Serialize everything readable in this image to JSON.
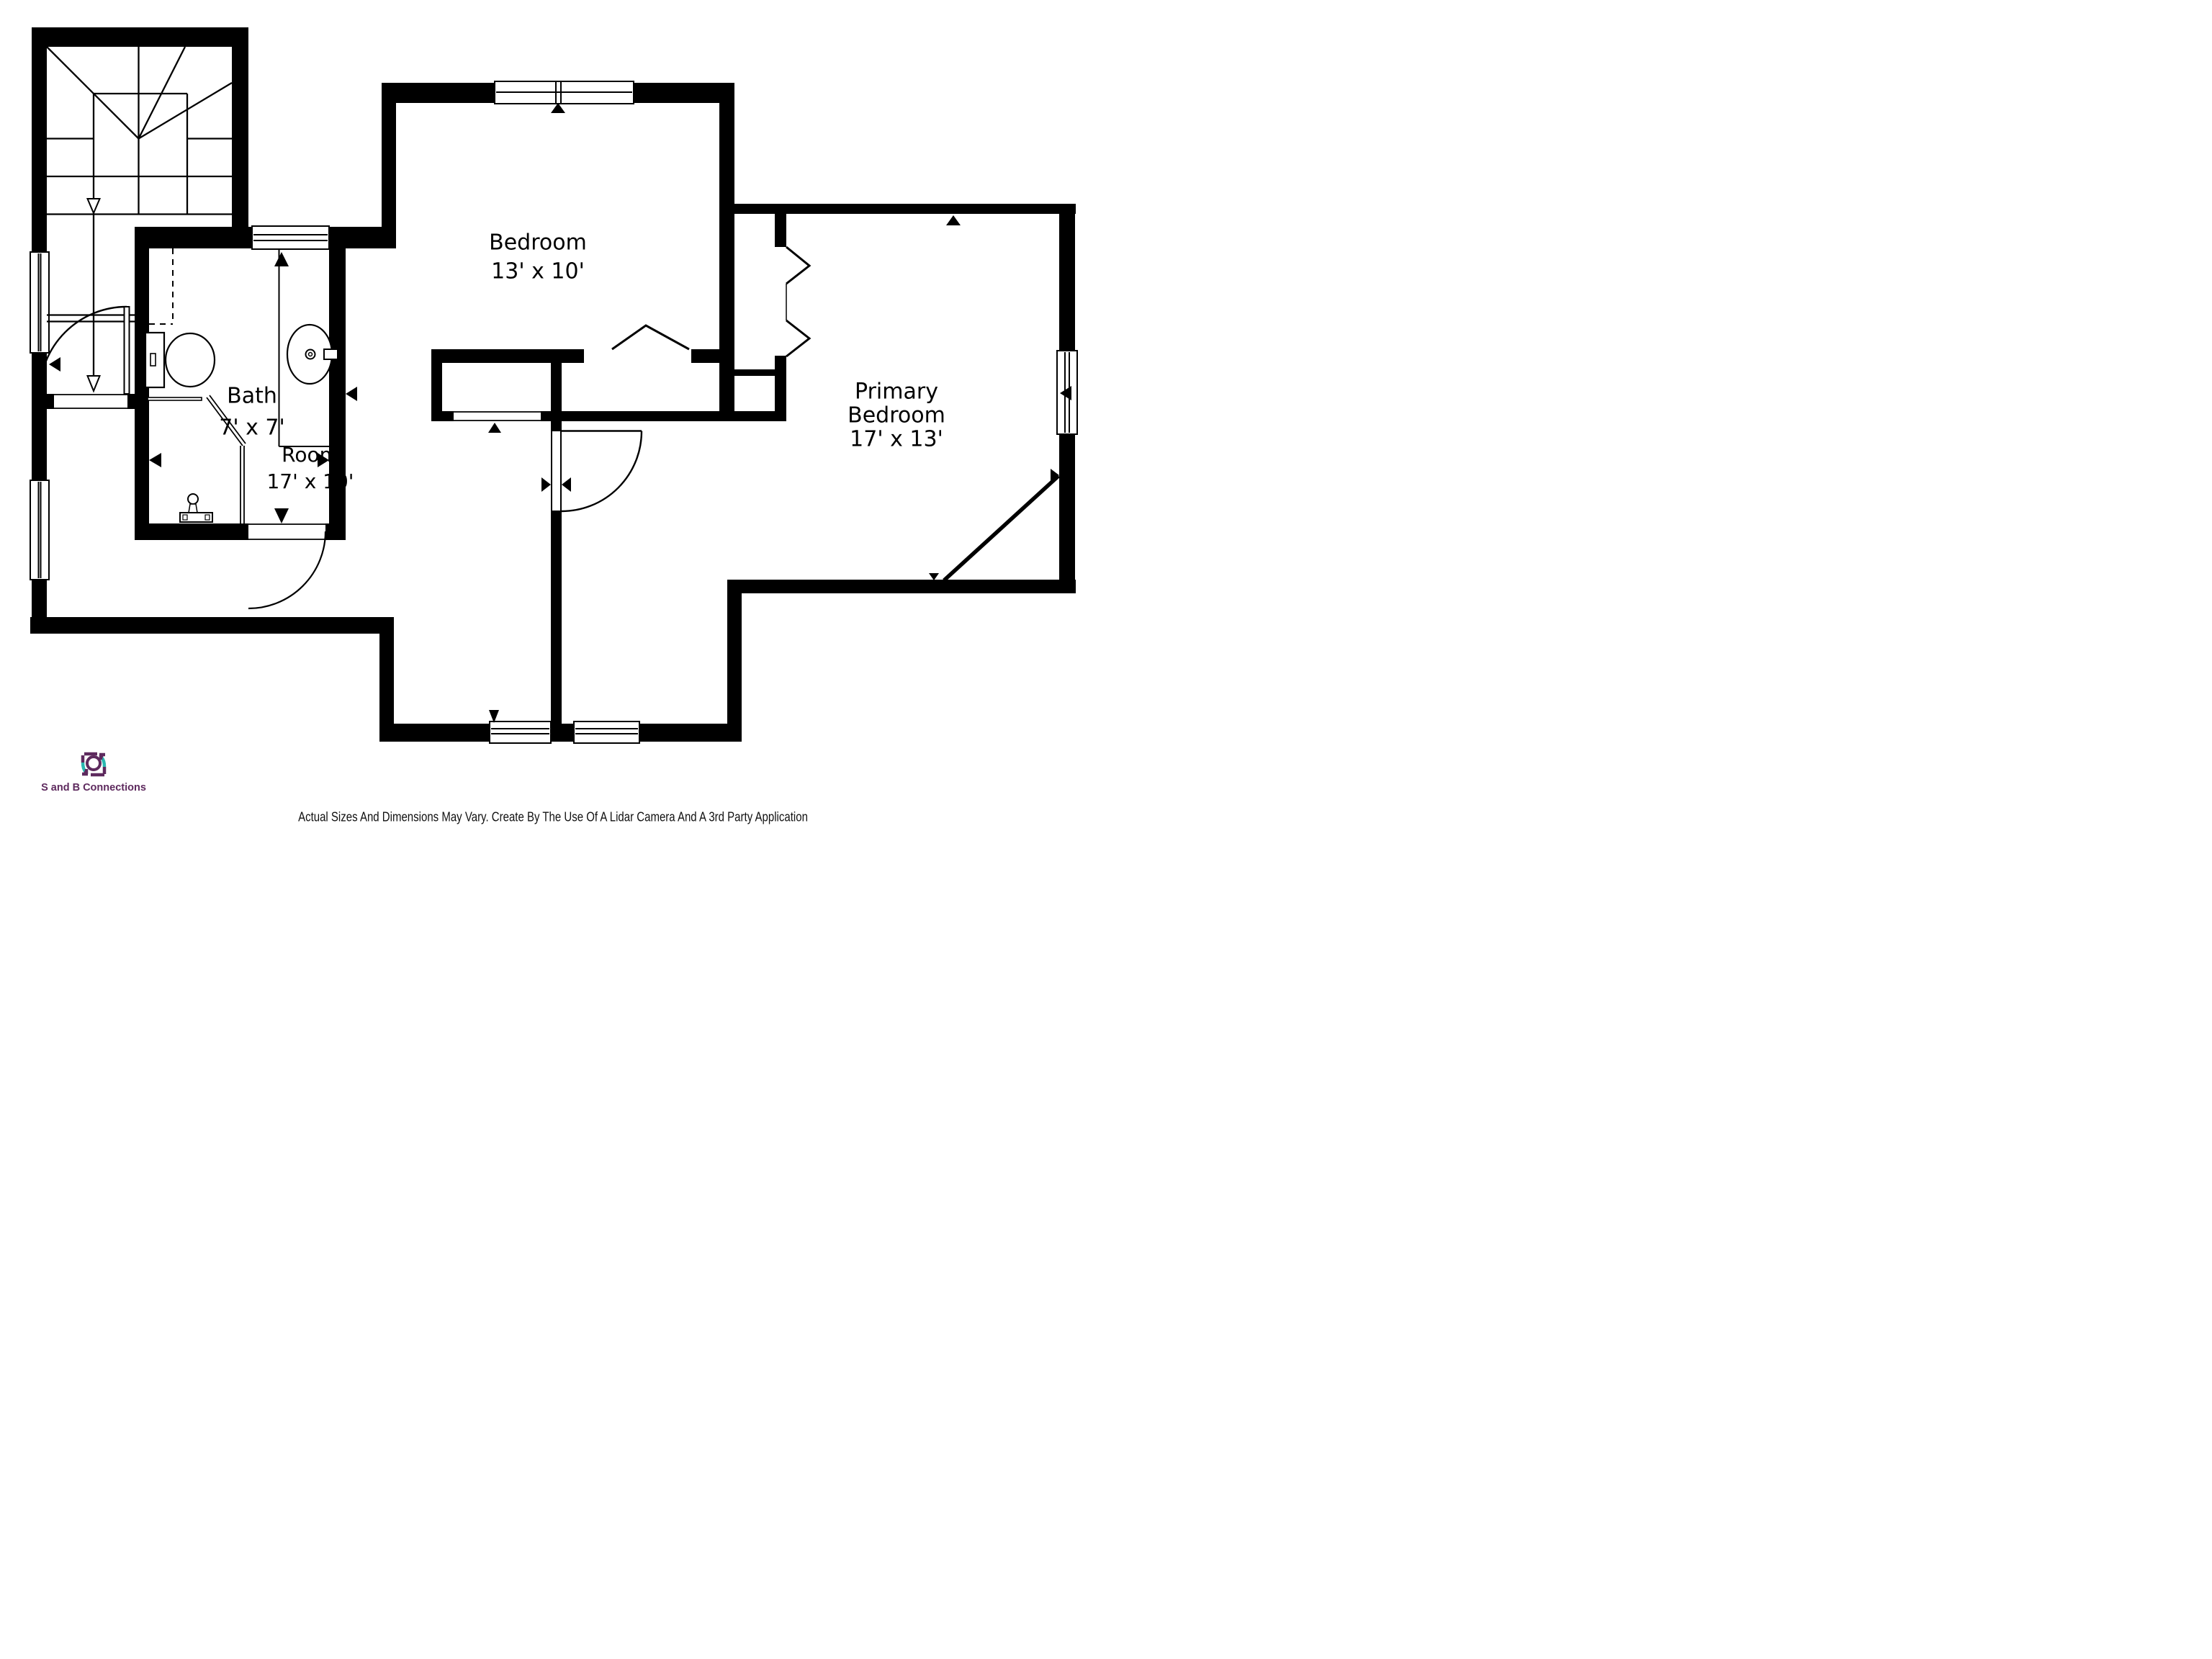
{
  "plan": {
    "rooms": [
      {
        "id": "bedroom",
        "name": "Bedroom",
        "dims": "13' x 10'"
      },
      {
        "id": "bath",
        "name": "Bath",
        "dims": "7' x 7'"
      },
      {
        "id": "room",
        "name": "Room",
        "dims": "17' x 10'"
      },
      {
        "id": "primary-bedroom",
        "name": "Primary Bedroom",
        "dims": "17' x 13'"
      }
    ],
    "symbols": [
      "stair-down-arrow",
      "door-swing-arc",
      "window",
      "closet-bifold-chevron",
      "toilet-icon",
      "sink-icon",
      "opening-marker-triangle"
    ]
  },
  "branding": {
    "logo_text": "S and B Connections",
    "logo_icon": "camera-icon",
    "purple": "#5E2A5E",
    "teal": "#2BB8B0"
  },
  "footer": {
    "disclaimer": "Actual Sizes And Dimensions May Vary. Create By The Use Of A Lidar Camera And A 3rd Party Application"
  },
  "colors": {
    "walls": "#000000",
    "background": "#ffffff",
    "text": "#000000"
  }
}
